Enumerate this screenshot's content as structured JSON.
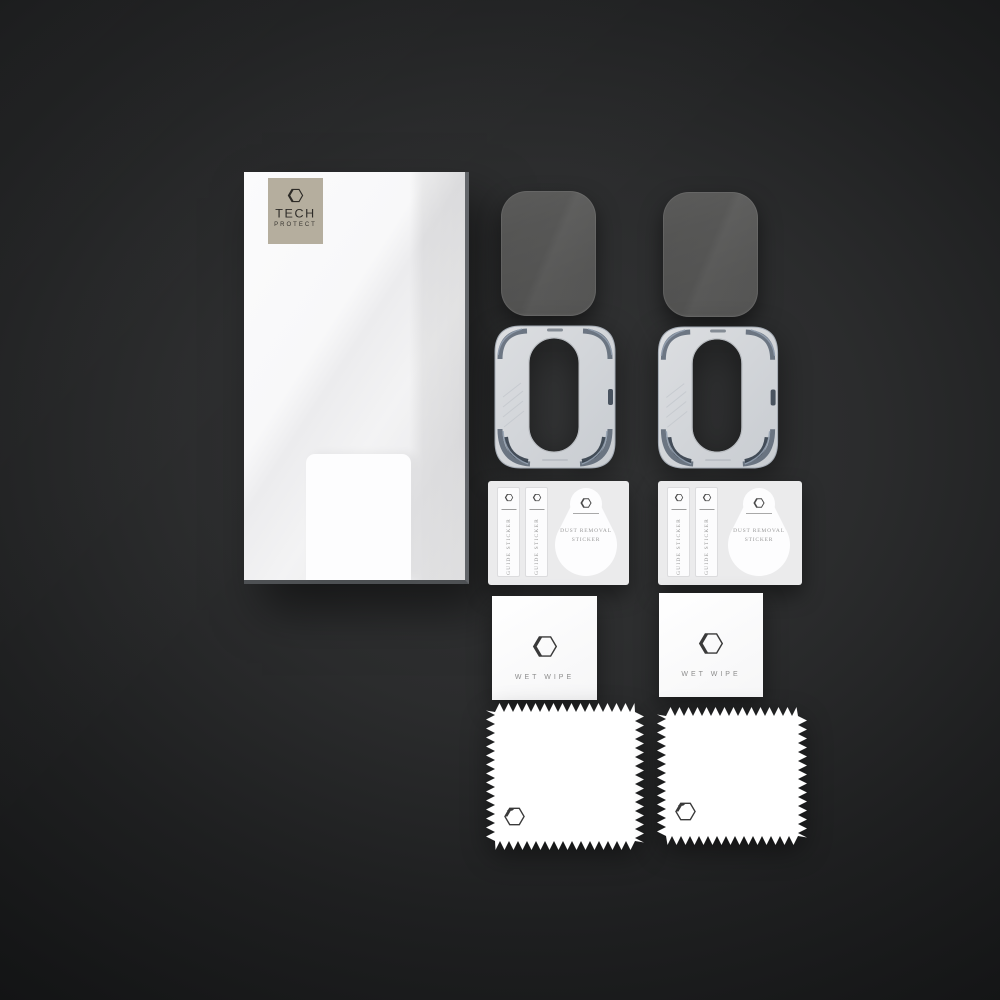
{
  "brand": {
    "name": "TECH",
    "subname": "PROTECT"
  },
  "labels": {
    "guide_sticker": "GUIDE STICKER",
    "dust_removal_line1": "DUST REMOVAL",
    "dust_removal_line2": "STICKER",
    "wet_wipe": "WET WIPE"
  },
  "colors": {
    "background_center": "#333435",
    "background_edge": "#101112",
    "brand_plate_beige": "#b5ae9e",
    "box_face_white": "#f3f3f4",
    "lens_glass_gray": "#5a5a59",
    "frame_body_gray": "#d5d8dc",
    "frame_accent_slate": "#56616f",
    "sheet_paper": "#ebebec",
    "muted_text": "#9a9a9a"
  }
}
